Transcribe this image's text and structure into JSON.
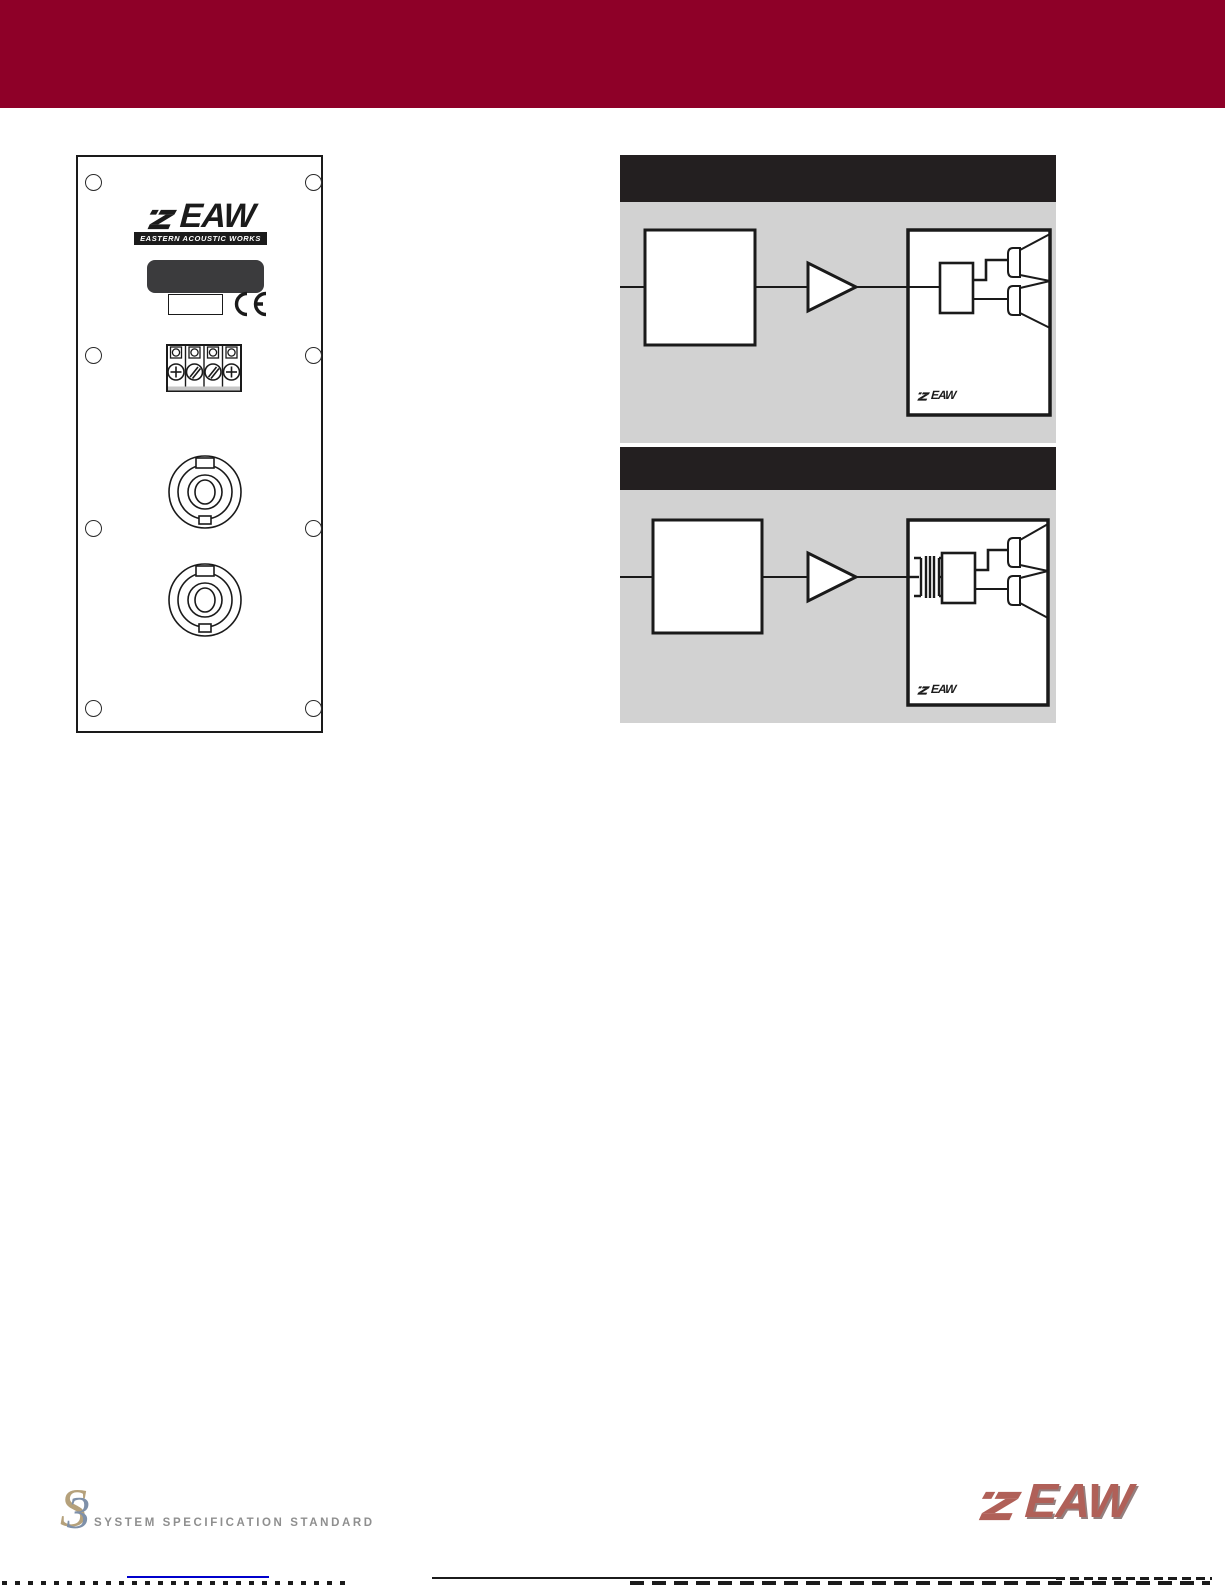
{
  "header": {
    "bg_color": "#8E0028"
  },
  "rear_panel": {
    "logo": {
      "name": "EAW",
      "tagline": "EASTERN ACOUSTIC WORKS"
    },
    "ce_mark": "CE",
    "screw_holes": 8,
    "terminal_positions": 4,
    "speakon_connectors": 2
  },
  "diagrams": {
    "panel_bg": "#D2D2D2",
    "header_bar_color": "#231F20",
    "items": [
      {
        "cabinet_logo": "EAW",
        "transformer": false
      },
      {
        "cabinet_logo": "EAW",
        "transformer": true
      }
    ]
  },
  "footer": {
    "s3": {
      "s": "S",
      "three": "3",
      "label": "SYSTEM SPECIFICATION STANDARD"
    },
    "eaw": {
      "name": "EAW",
      "color": "#B06058"
    },
    "link_color": "#0000CC"
  }
}
